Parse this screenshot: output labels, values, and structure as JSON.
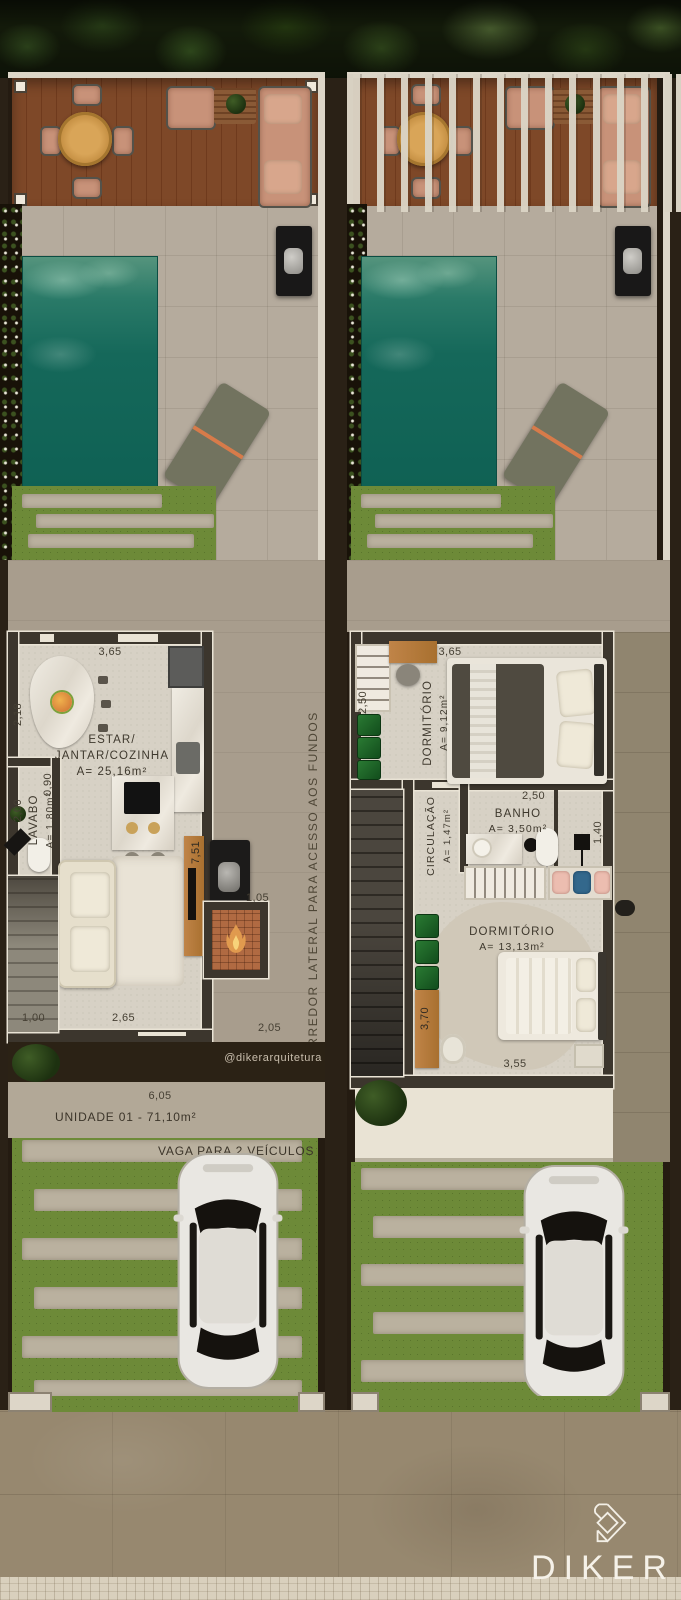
{
  "brand": {
    "wordmark": "DIKER"
  },
  "watermark": "@dikerarquitetura",
  "corridor": {
    "label": "CORREDOR LATERAL PARA ACESSO AOS FUNDOS"
  },
  "site": {
    "front_width": "6,05",
    "unit_label": "UNIDADE 01 - 71,10m²",
    "parking_label": "VAGA PARA 2 VEÍCULOS"
  },
  "ground_floor": {
    "living": {
      "line1": "ESTAR/",
      "line2": "JANTAR/COZINHA",
      "area": "A= 25,16m²"
    },
    "lavabo": {
      "name": "LAVABO",
      "area": "A= 1,80m²"
    },
    "dims": {
      "top": "3,65",
      "dining_side": "2,18",
      "lavabo_width": "0,90",
      "lavabo_height": "2,00",
      "kitchen_side": "7,51",
      "grill_nook": "1,05",
      "bottom_left": "1,00",
      "bottom_center": "2,65",
      "corridor_bottom": "2,05"
    }
  },
  "upper_floor": {
    "bedroom1": {
      "name": "DORMITÓRIO",
      "area": "A= 9,12m²"
    },
    "circulation": {
      "name": "CIRCULAÇÃO",
      "area": "A= 1,47m²"
    },
    "bathroom": {
      "name": "BANHO",
      "area": "A= 3,50m²"
    },
    "bedroom2": {
      "name": "DORMITÓRIO",
      "area": "A= 13,13m²"
    },
    "dims": {
      "top": "3,65",
      "closet_side": "2,50",
      "bathroom_top": "2,50",
      "bathroom_right": "1,40",
      "bedroom2_left": "3,70",
      "bedroom2_bottom": "3,55"
    }
  },
  "colors": {
    "pool": "#0f6154",
    "deck": "#7e4828",
    "grass": "#6d8a38",
    "wall": "#3c362d",
    "fire_accent": "#b06a42",
    "logo": "#f5f1e8"
  }
}
